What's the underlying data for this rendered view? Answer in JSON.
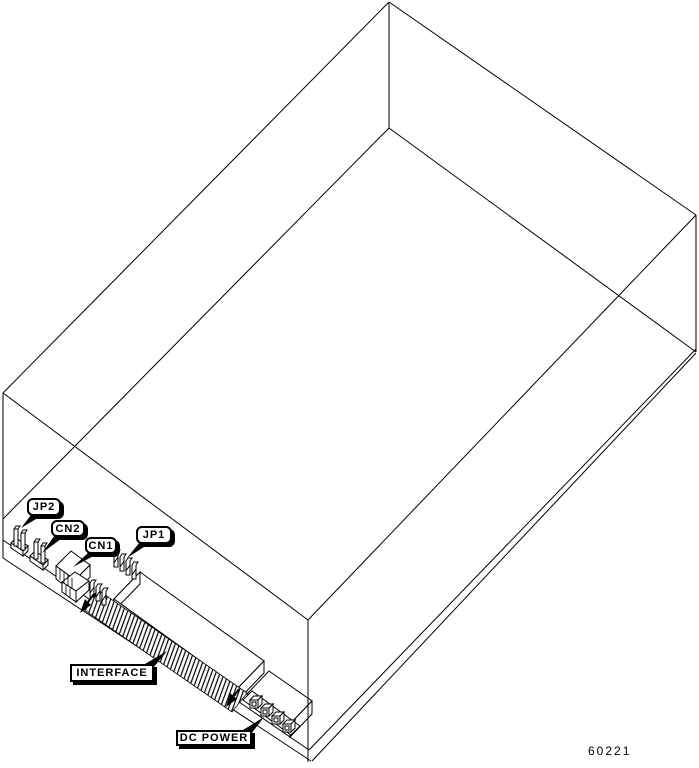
{
  "colors": {
    "line": "#000000",
    "background": "#ffffff"
  },
  "labels": {
    "jp2": "JP2",
    "cn2": "CN2",
    "cn1": "CN1",
    "jp1": "JP1",
    "interface": "INTERFACE",
    "dc_power": "DC POWER"
  },
  "figure_number": "60221"
}
